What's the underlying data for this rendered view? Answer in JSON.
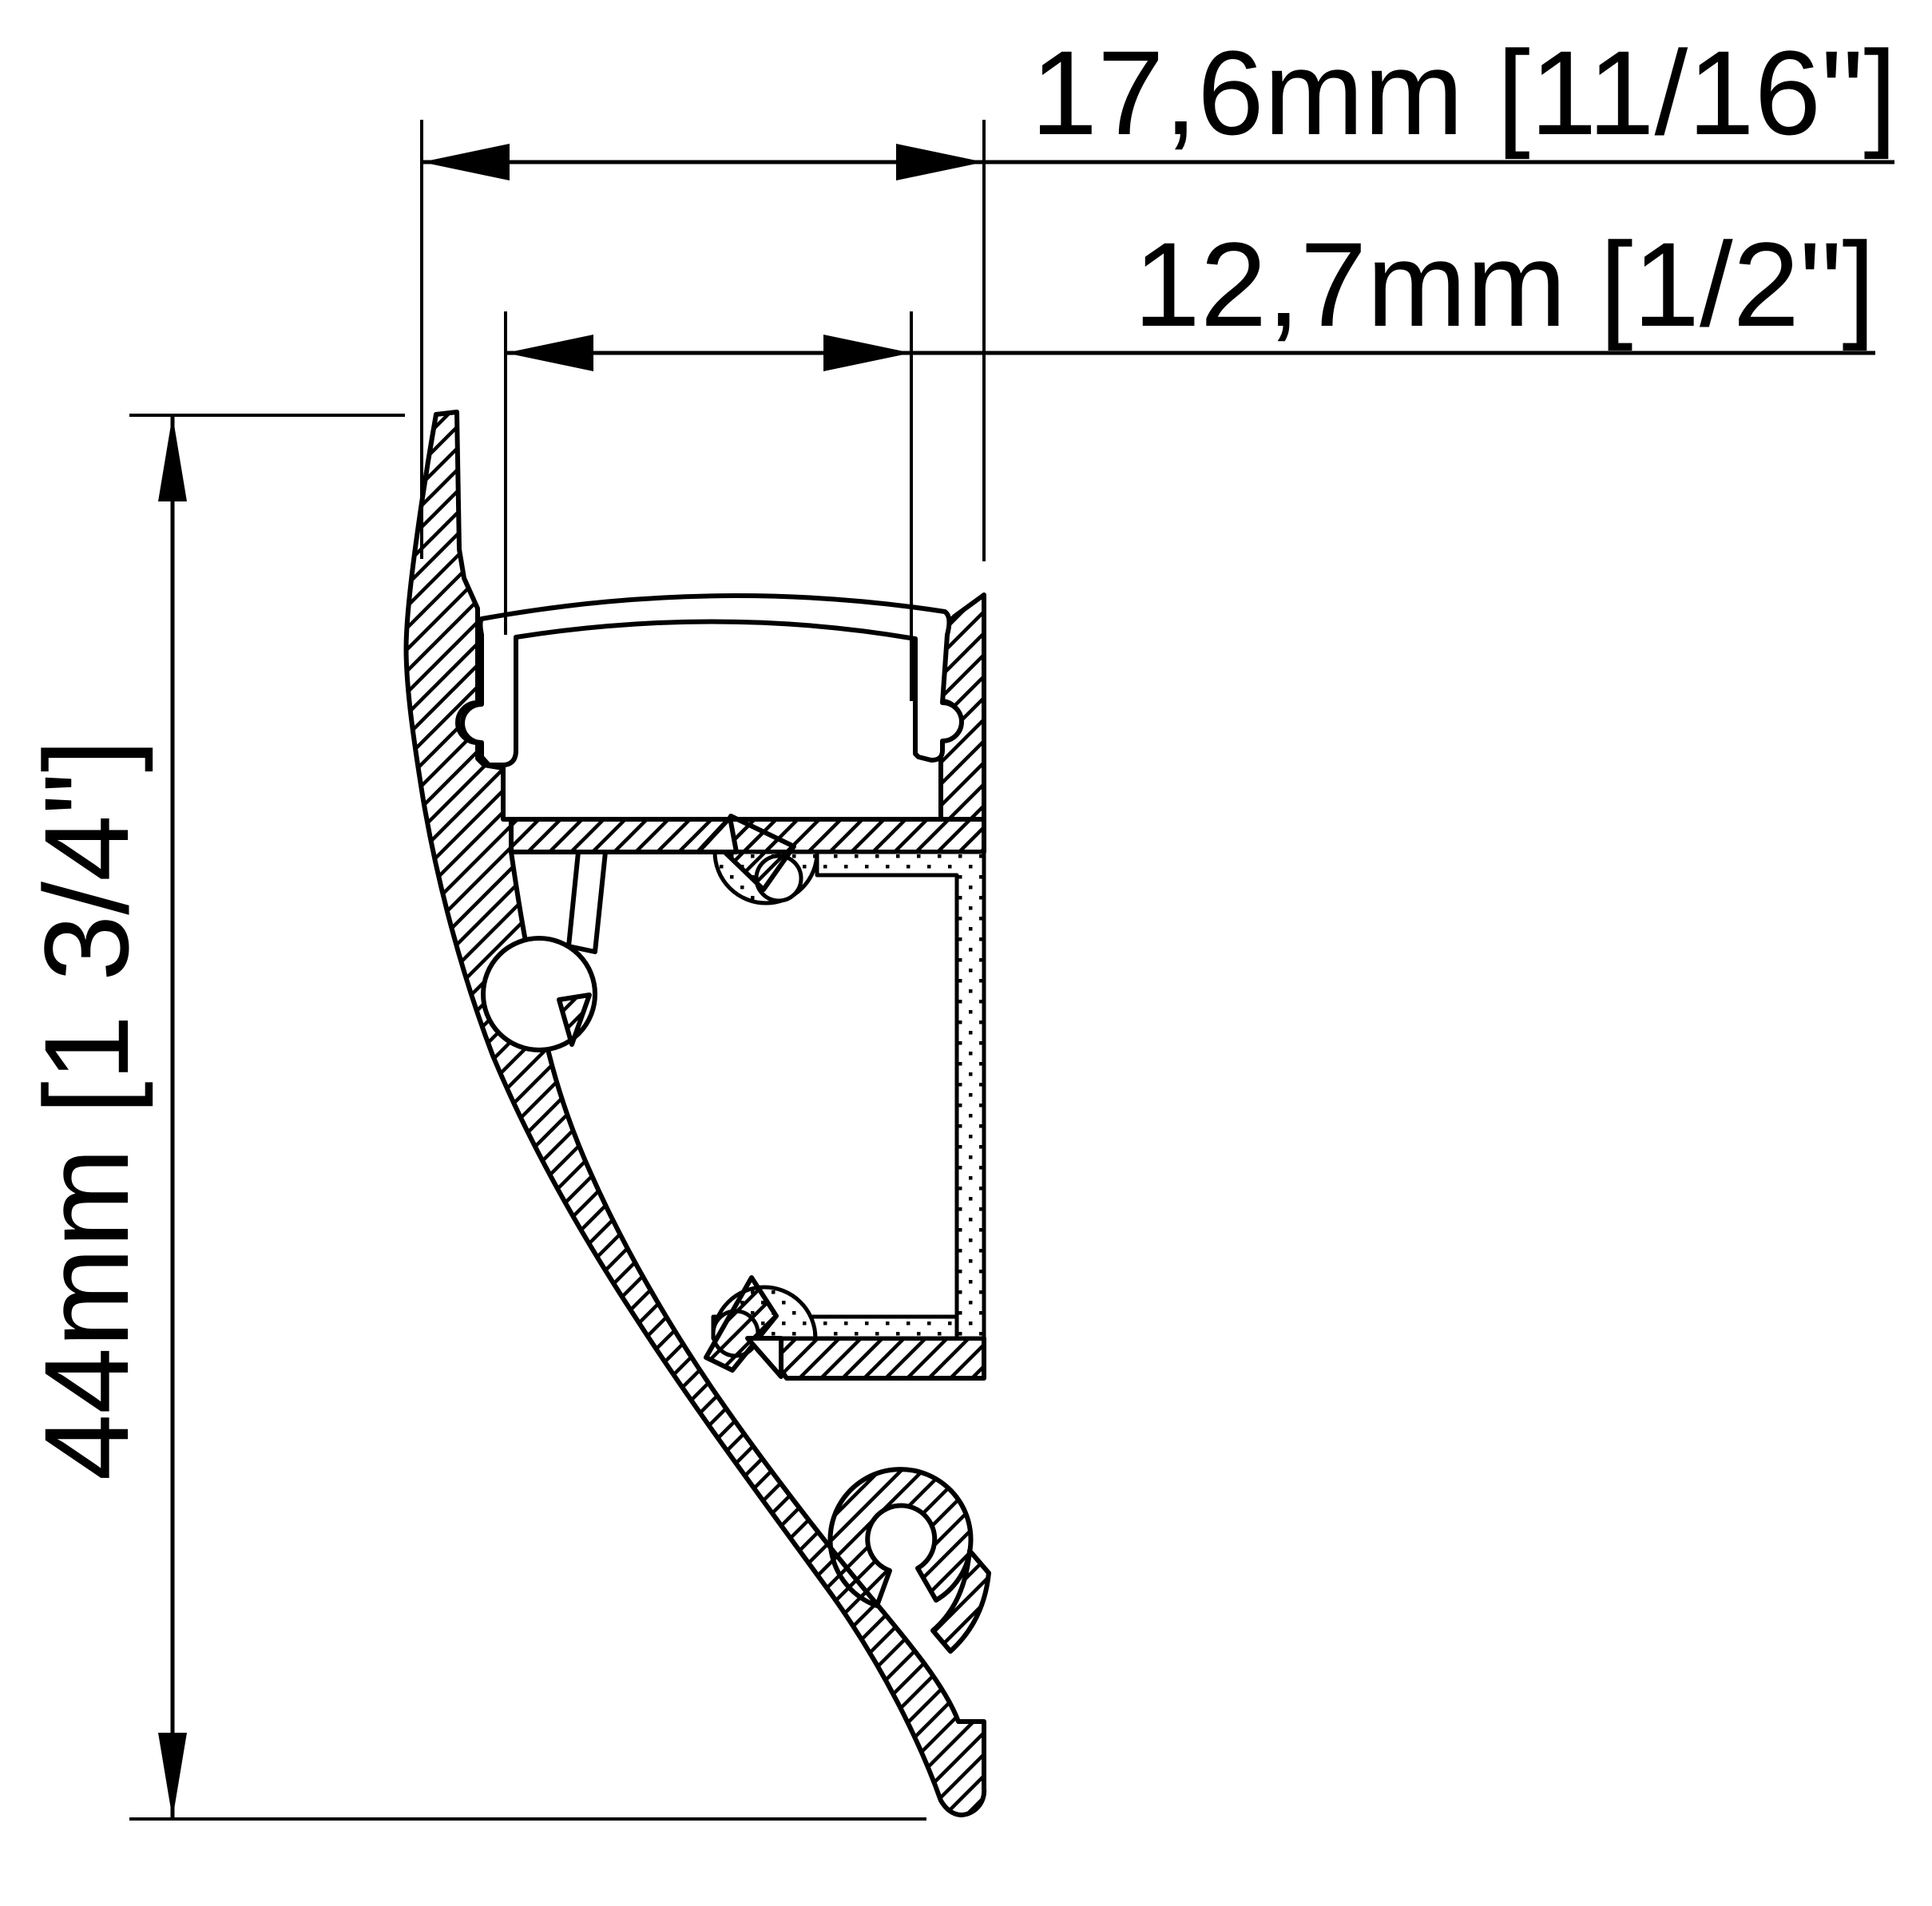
{
  "drawing": {
    "description": "Technical cross-section drawing of a curved wall-mount LED aluminium profile with diffuser lens, mounting clips and adhesive liner",
    "background_color": "#ffffff",
    "line_color": "#000000",
    "dimensions": {
      "width_overall": {
        "label": "17,6mm [11/16\"]",
        "mm": 17.6,
        "inch": "11/16"
      },
      "width_inner": {
        "label": "12,7mm [1/2\"]",
        "mm": 12.7,
        "inch": "1/2"
      },
      "height_overall": {
        "label": "44mm [1 3/4\"]",
        "mm": 44,
        "inch": "1 3/4"
      }
    },
    "legend": {
      "hatched": "aluminium (cut material)",
      "dotted": "adhesive / liner material",
      "white": "translucent lens / voids"
    }
  }
}
